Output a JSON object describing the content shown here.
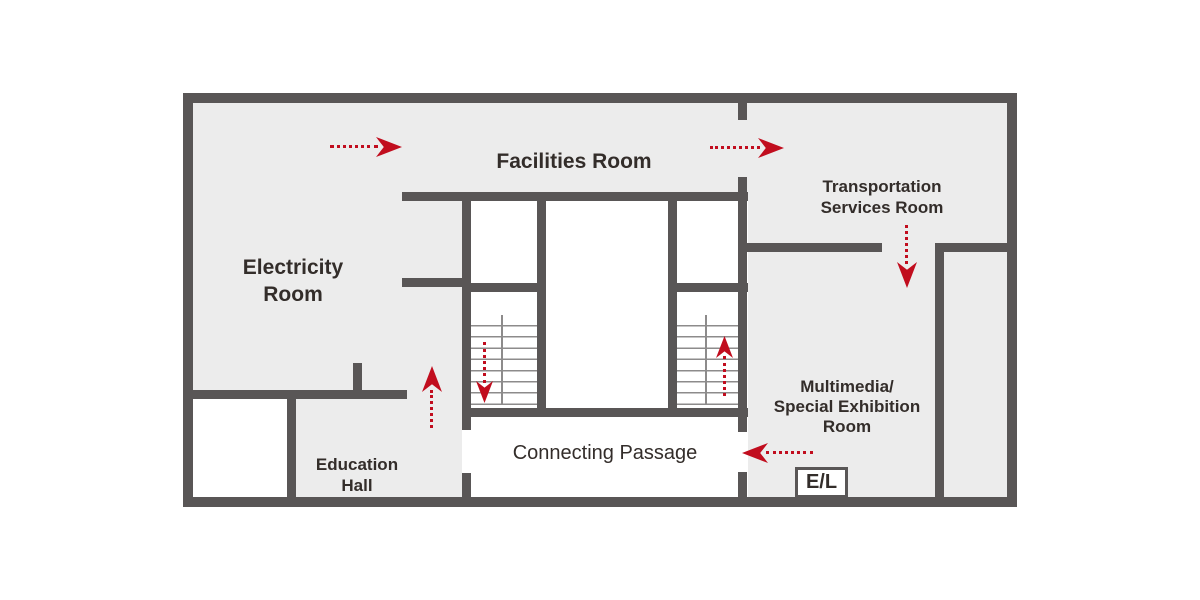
{
  "colors": {
    "wall": "#595656",
    "floor": "#ececec",
    "route_arrow": "#c10d1e",
    "text": "#332d2a"
  },
  "rooms": {
    "facilities": {
      "label": "Facilities Room"
    },
    "electricity": {
      "line1": "Electricity",
      "line2": "Room"
    },
    "transportation": {
      "line1": "Transportation",
      "line2": "Services Room"
    },
    "multimedia": {
      "line1": "Multimedia/",
      "line2": "Special Exhibition",
      "line3": "Room"
    },
    "education": {
      "line1": "Education",
      "line2": "Hall"
    },
    "connecting_passage": {
      "label": "Connecting Passage"
    },
    "elevator": {
      "label": "E/L"
    }
  },
  "arrows": [
    {
      "id": "a1",
      "name": "route-arrow-facilities-east",
      "direction": "right"
    },
    {
      "id": "a2",
      "name": "route-arrow-to-transportation-east",
      "direction": "right"
    },
    {
      "id": "a3",
      "name": "route-arrow-transportation-south",
      "direction": "down"
    },
    {
      "id": "a4",
      "name": "route-arrow-corridor-north",
      "direction": "up"
    },
    {
      "id": "a5",
      "name": "route-arrow-left-staircase-down",
      "direction": "down"
    },
    {
      "id": "a6",
      "name": "route-arrow-right-staircase-up",
      "direction": "up"
    },
    {
      "id": "a7",
      "name": "route-arrow-into-passage-west",
      "direction": "left"
    }
  ]
}
